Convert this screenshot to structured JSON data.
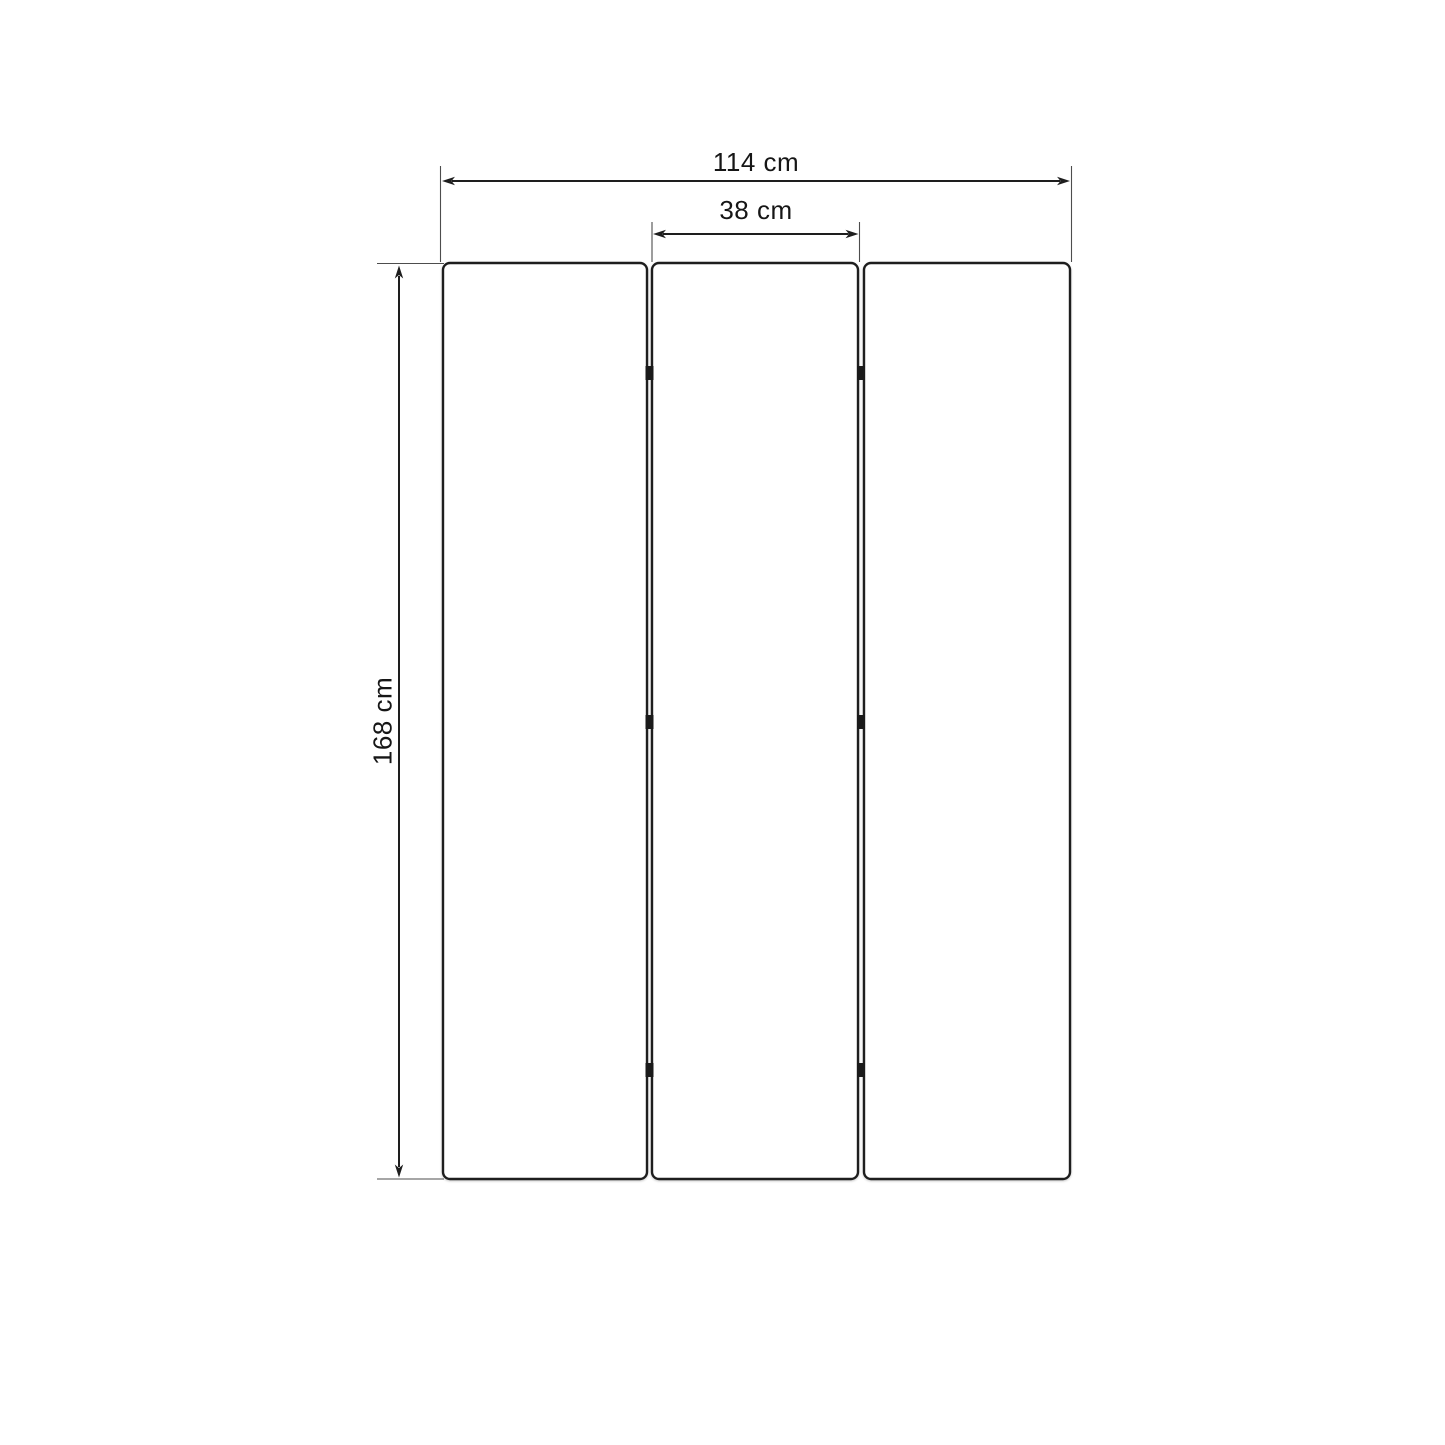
{
  "diagram": {
    "type": "furniture-dimension-diagram",
    "panel_count": 3,
    "hinge_count": 6,
    "dimensions": {
      "total_width": {
        "label": "114 cm"
      },
      "panel_width": {
        "label": "38 cm"
      },
      "height": {
        "label": "168 cm"
      }
    },
    "colors": {
      "background": "#ffffff",
      "panel_fill": "#ffffff",
      "outline": "#1e1e1e",
      "extension_line": "#4d4d4d",
      "hinge": "#1a1a1a",
      "text": "#161616"
    }
  }
}
